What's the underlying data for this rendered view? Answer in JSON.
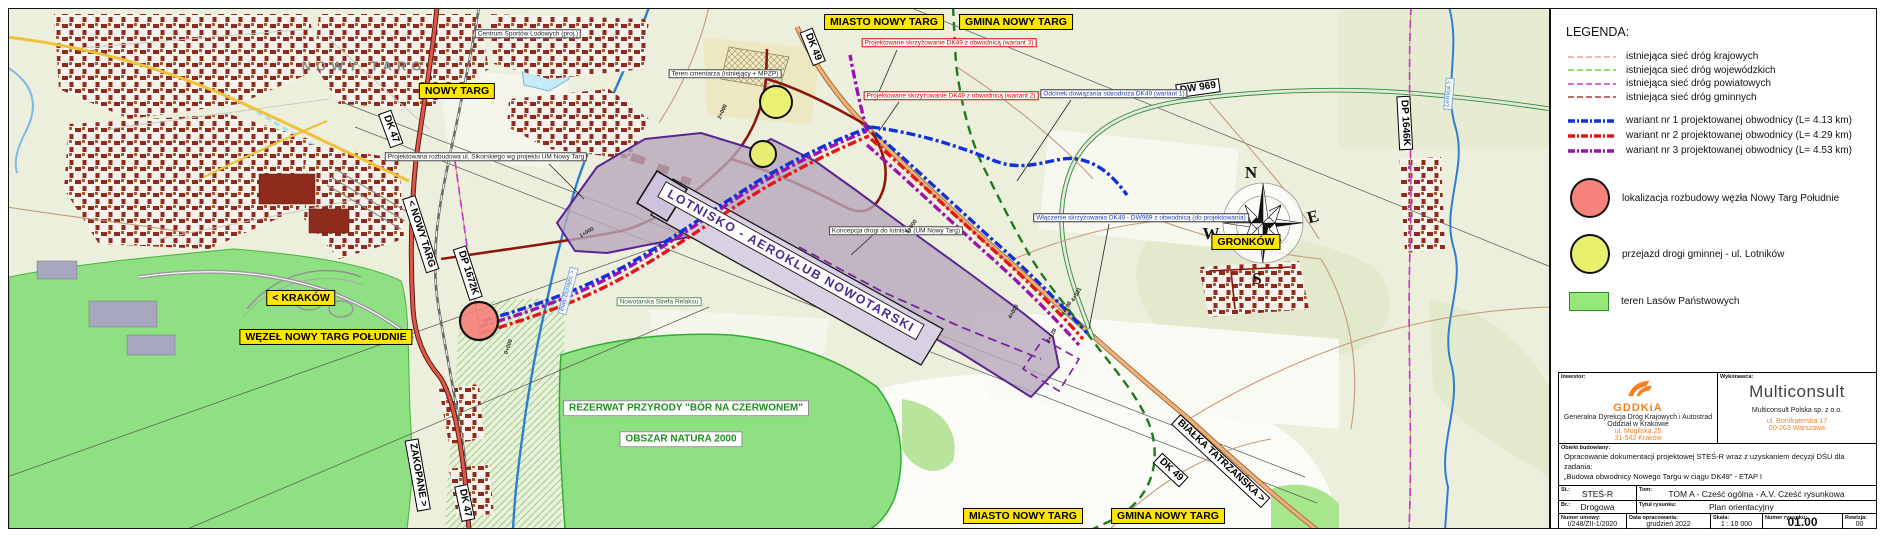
{
  "sheet": {
    "compass": {
      "n": "N",
      "e": "E",
      "s": "S",
      "w": "W"
    }
  },
  "map": {
    "yellow_labels": [
      {
        "id": "miasto-nowy-targ-top",
        "text": "MIASTO NOWY TARG",
        "x": 875,
        "y": 13
      },
      {
        "id": "gmina-nowy-targ-top",
        "text": "GMINA NOWY TARG",
        "x": 1007,
        "y": 13
      },
      {
        "id": "nowy-targ",
        "text": "NOWY TARG",
        "x": 448,
        "y": 82
      },
      {
        "id": "krakow-direction",
        "text": "< KRAKÓW",
        "x": 292,
        "y": 289
      },
      {
        "id": "wezel-nowy-targ-poludnie",
        "text": "WĘZEŁ NOWY TARG POŁUDNIE",
        "x": 317,
        "y": 328
      },
      {
        "id": "gronkow",
        "text": "GRONKÓW",
        "x": 1237,
        "y": 233
      },
      {
        "id": "miasto-nowy-targ-bottom",
        "text": "MIASTO NOWY TARG",
        "x": 1014,
        "y": 507
      },
      {
        "id": "gmina-nowy-targ-bottom",
        "text": "GMINA NOWY TARG",
        "x": 1159,
        "y": 507
      }
    ],
    "road_labels": [
      {
        "id": "dk47-top",
        "text": "DK 47",
        "x": 382,
        "y": 120,
        "rot": 70
      },
      {
        "id": "dk49-top",
        "text": "DK 49",
        "x": 804,
        "y": 38,
        "rot": 68
      },
      {
        "id": "dw969",
        "text": "DW 969",
        "x": 1189,
        "y": 79,
        "rot": -8
      },
      {
        "id": "dp1646k",
        "text": "DP 1646K",
        "x": 1396,
        "y": 114,
        "rot": 87
      },
      {
        "id": "nowy-targ-direction",
        "text": "< NOWY TARG",
        "x": 412,
        "y": 225,
        "rot": 72
      },
      {
        "id": "dp1672k",
        "text": "DP 1672K",
        "x": 459,
        "y": 264,
        "rot": 72
      },
      {
        "id": "zakopane-direction",
        "text": "ZAKOPANE >",
        "x": 409,
        "y": 466,
        "rot": 80
      },
      {
        "id": "dk47-bottom",
        "text": "DK 47",
        "x": 456,
        "y": 494,
        "rot": 78
      },
      {
        "id": "bialka-direction",
        "text": "BIAŁKA TATRZAŃSKA >",
        "x": 1212,
        "y": 452,
        "rot": 43
      },
      {
        "id": "dk49-bottom",
        "text": "DK 49",
        "x": 1162,
        "y": 461,
        "rot": 43
      }
    ],
    "annotations": [
      {
        "id": "skrzyzowanie-w3",
        "text": "Projektowane skrzyżowanie DK49 z obwodnicą (wariant 3)",
        "x": 940,
        "y": 34,
        "color": "#d40000"
      },
      {
        "id": "skrzyzowanie-w2",
        "text": "Projektowane skrzyżowanie DK49 z obwodnicą (wariant 2)",
        "x": 942,
        "y": 87,
        "color": "#d40000"
      },
      {
        "id": "odcinek-w1",
        "text": "Odcinek dowiązania starodroża DK49 (wariant 1)",
        "x": 1105,
        "y": 85,
        "color": "#1b3fbf",
        "border": "#333333"
      },
      {
        "id": "wlaczenie-dw969",
        "text": "Włączenie skrzyżowania DK49 - DW969 z obwodnicą (do projektowania)",
        "x": 1132,
        "y": 209,
        "color": "#1b3fbf",
        "border": "#333333"
      },
      {
        "id": "koncepcja-lotnisko",
        "text": "Koncepcja drogi do lotniska (UM Nowy Targ)",
        "x": 887,
        "y": 222,
        "color": "#222222",
        "border": "#444444"
      },
      {
        "id": "teren-cmentarza",
        "text": "Teren cmentarza (istniejący + MPZP)",
        "x": 716,
        "y": 65,
        "color": "#222222",
        "border": "#444444"
      },
      {
        "id": "rozbudowa-sikorskiego",
        "text": "Projektowana rozbudowa ul. Sikorskiego wg projektu UM Nowy Targ",
        "x": 477,
        "y": 148,
        "color": "#222222",
        "border": "#444444"
      },
      {
        "id": "strefa-relaksu",
        "text": "Nowotarska Strefa Relaksu",
        "x": 650,
        "y": 293,
        "color": "#2c5d2c",
        "border": "#5d8f5d"
      },
      {
        "id": "centrum-sportow",
        "text": "Centrum Sportów Lodowych (proj.)",
        "x": 519,
        "y": 25,
        "color": "#222222",
        "border": "#444444"
      }
    ],
    "area_labels": [
      {
        "id": "lotnisko",
        "text": "LOTNISKO - AEROKLUB NOWOTARSKI",
        "x": 782,
        "y": 252,
        "rot": 29,
        "kind": "lotnisko"
      },
      {
        "id": "rezerwat",
        "text": "REZERWAT PRZYRODY \"BÓR NA CZERWONEM\"",
        "x": 677,
        "y": 399,
        "kind": "reserve"
      },
      {
        "id": "natura-2000",
        "text": "OBSZAR NATURA 2000",
        "x": 672,
        "y": 430,
        "kind": "reserve"
      },
      {
        "id": "town-name",
        "text": "NOWY TARG",
        "x": 355,
        "y": 58,
        "kind": "townname"
      }
    ],
    "river_labels": [
      {
        "id": "bialy-dunajec",
        "text": "Biały Dunajec >",
        "x": 559,
        "y": 282,
        "rot": -75
      },
      {
        "id": "lesnica",
        "text": "Leśnica >",
        "x": 1440,
        "y": 85,
        "rot": -85
      }
    ],
    "km_labels": [
      {
        "id": "km-0",
        "text": "0+000",
        "x": 500,
        "y": 338,
        "rot": -70
      },
      {
        "id": "km-1",
        "text": "1+000",
        "x": 578,
        "y": 224,
        "rot": -30
      },
      {
        "id": "km-2",
        "text": "2+000",
        "x": 714,
        "y": 103,
        "rot": -65
      },
      {
        "id": "km-3",
        "text": "3+000",
        "x": 903,
        "y": 218,
        "rot": -55
      },
      {
        "id": "km-4",
        "text": "4+000",
        "x": 1005,
        "y": 303,
        "rot": -60
      },
      {
        "id": "km-4128",
        "text": "4+128",
        "x": 1043,
        "y": 327,
        "rot": -60
      },
      {
        "id": "km-4298",
        "text": "4+298",
        "x": 1058,
        "y": 300,
        "rot": -60
      },
      {
        "id": "km-4531",
        "text": "4+531",
        "x": 1068,
        "y": 286,
        "rot": -60
      }
    ]
  },
  "legend": {
    "title": "LEGENDA:",
    "road_items": [
      {
        "label": "istniejąca sieć dróg krajowych",
        "color": "#e8a49a"
      },
      {
        "label": "istniejąca sieć dróg wojewódzkich",
        "color": "#6fd43a"
      },
      {
        "label": "istniejąca sieć dróg powiatowych",
        "color": "#c93bc9"
      },
      {
        "label": "istniejąca sieć dróg gminnych",
        "color": "#a53d30"
      }
    ],
    "variant_items": [
      {
        "label": "wariant nr 1 projektowanej obwodnicy (L= 4.13 km)",
        "color": "#1030d8"
      },
      {
        "label": "wariant nr 2 projektowanej obwodnicy (L= 4.29 km)",
        "color": "#e31515"
      },
      {
        "label": "wariant nr 3 projektowanej obwodnicy (L= 4.53 km)",
        "color": "#9914ad"
      }
    ],
    "point_items": [
      {
        "label": "lokalizacja rozbudowy węzła Nowy Targ Południe",
        "color": "#f5837b"
      },
      {
        "label": "przejazd drogi gminnej - ul. Lotników",
        "color": "#e9f06e"
      }
    ],
    "area_item": {
      "label": "teren Lasów Państwowych",
      "color": "#97e87a"
    }
  },
  "title_block": {
    "investor_label": "Inwestor:",
    "investor_logo": "GDDKiA",
    "investor_name": "Generalna Dyrekcja Dróg Krajowych i Autostrad",
    "investor_branch": "Oddział w Krakowie",
    "investor_street": "ul. Mogilska 25",
    "investor_city": "31-542 Kraków",
    "contractor_label": "Wykonawca:",
    "contractor_logo": "Multiconsult",
    "contractor_name": "Multiconsult Polska sp. z o.o.",
    "contractor_street": "ul. Bonifraterska 17",
    "contractor_city": "00-203 Warszawa",
    "object_label": "Obiekt budowlany:",
    "object_line1": "Opracowanie dokumentacji projektowej STEŚ-R wraz z uzyskaniem decyzji DŚU dla zadania:",
    "object_line2": "„Budowa obwodnicy Nowego Targu w ciągu DK49” - ETAP I",
    "stage_label": "St.:",
    "stage_value": "STEŚ-R",
    "volume_label": "Tom:",
    "volume_value": "TOM A - Cześć ogólna - A.V. Cześć rysunkowa",
    "branch_label": "Br.:",
    "branch_value": "Drogowa",
    "drawing_title_label": "Tytuł rysunku:",
    "drawing_title_value": "Plan orientacyjny",
    "contract_label": "Numer umowy:",
    "contract_value": "I/248/ZII-1/2020",
    "date_label": "Data opracowania:",
    "date_value": "grudzień 2022",
    "scale_label": "Skala:",
    "scale_value": "1 : 10 000",
    "drawing_no_label": "Numer rysunku:",
    "drawing_no_value": "01.00",
    "revision_label": "Rewizja:",
    "revision_value": "00"
  }
}
